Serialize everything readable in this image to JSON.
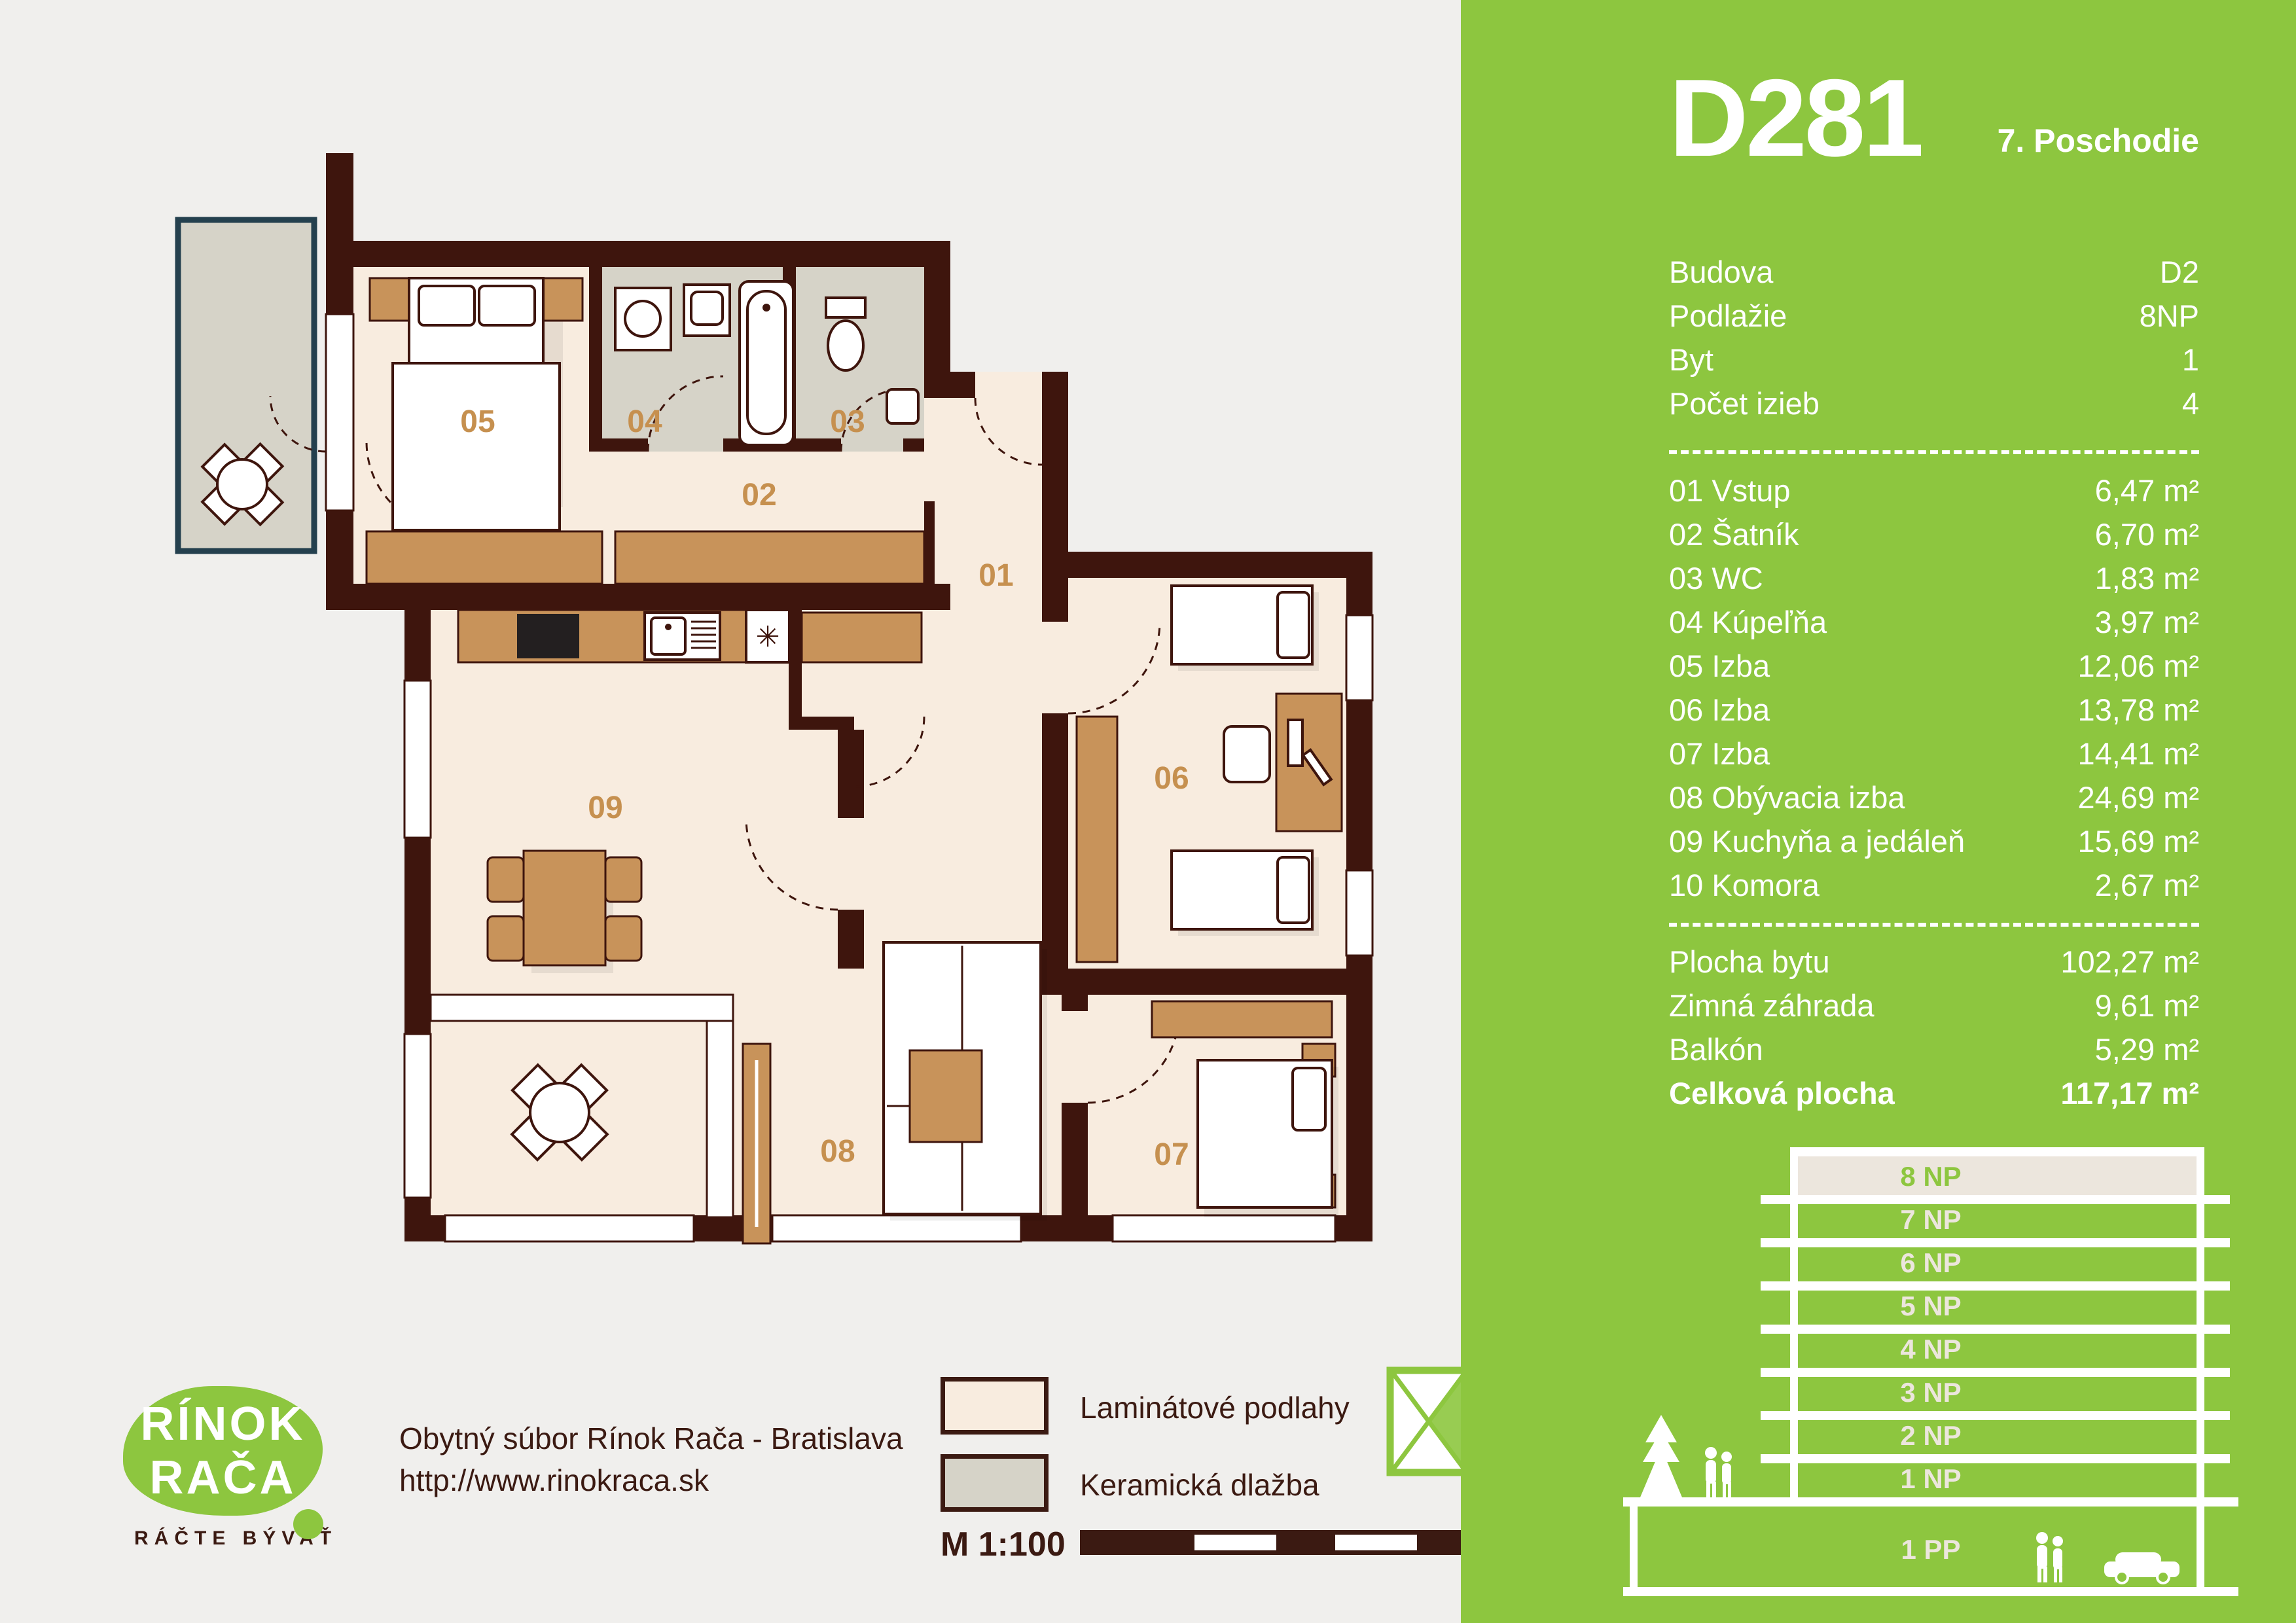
{
  "title": {
    "unit_id": "D281",
    "floor_title": "7. Poschodie"
  },
  "panel": {
    "info": [
      {
        "label": "Budova",
        "value": "D2"
      },
      {
        "label": "Podlažie",
        "value": "8NP"
      },
      {
        "label": "Byt",
        "value": "1"
      },
      {
        "label": "Počet izieb",
        "value": "4"
      }
    ],
    "rooms": [
      {
        "label": "01 Vstup",
        "area": "6,47 m²"
      },
      {
        "label": "02 Šatník",
        "area": "6,70 m²"
      },
      {
        "label": "03 WC",
        "area": "1,83 m²"
      },
      {
        "label": "04 Kúpeľňa",
        "area": "3,97 m²"
      },
      {
        "label": "05 Izba",
        "area": "12,06 m²"
      },
      {
        "label": "06 Izba",
        "area": "13,78 m²"
      },
      {
        "label": "07 Izba",
        "area": "14,41 m²"
      },
      {
        "label": "08 Obývacia izba",
        "area": "24,69 m²"
      },
      {
        "label": "09 Kuchyňa a jedáleň",
        "area": "15,69 m²"
      },
      {
        "label": "10 Komora",
        "area": "2,67 m²"
      }
    ],
    "totals": [
      {
        "label": "Plocha bytu",
        "value": "102,27 m²"
      },
      {
        "label": "Zimná záhrada",
        "value": "9,61 m²"
      },
      {
        "label": "Balkón",
        "value": "5,29 m²"
      },
      {
        "label": "Celková plocha",
        "value": "117,17 m²"
      }
    ],
    "floors": [
      "8 NP",
      "7 NP",
      "6 NP",
      "5 NP",
      "4 NP",
      "3 NP",
      "2 NP",
      "1 NP",
      "1 PP"
    ]
  },
  "plan": {
    "labels": [
      "05",
      "04",
      "03",
      "02",
      "01",
      "09",
      "06",
      "08",
      "07"
    ],
    "fridge_symbol": "✳"
  },
  "legend": {
    "laminate": "Laminátové podlahy",
    "ceramic": "Keramická dlažba",
    "scale_label": "M 1:100"
  },
  "footer": {
    "brand_line1": "RÍNOK",
    "brand_line2": "RAČA",
    "tagline": "RÁČTE BÝVAŤ",
    "line1": "Obytný súbor Rínok Rača - Bratislava",
    "line2": "http://www.rinokraca.sk"
  },
  "colors": {
    "green": "#8dc63f",
    "wall": "#3e150d",
    "laminate": "#f8ecdf",
    "ceramic": "#d6d3c8",
    "furniture_tan": "#c8935a",
    "label_tan": "#c6904f",
    "dark_text": "#3b1a12",
    "page_bg": "#f0efed",
    "floor_highlight": "#ece6dd",
    "balcony_frame": "#24404e"
  }
}
